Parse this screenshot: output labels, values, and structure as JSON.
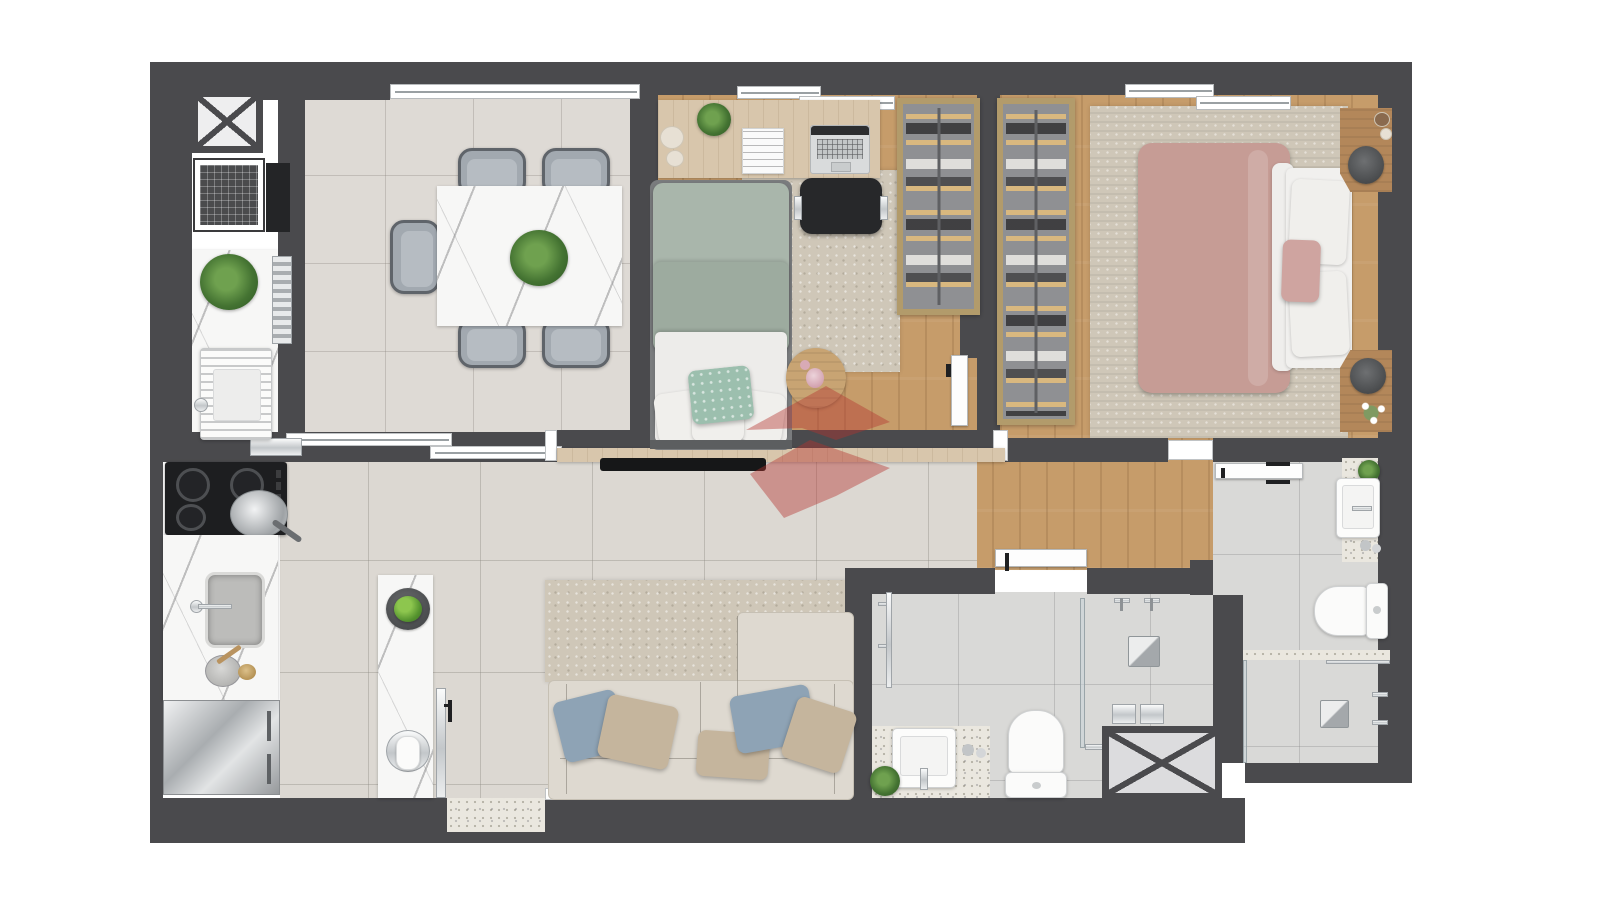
{
  "meta": {
    "type": "apartment-floor-plan",
    "style": "top-down 3D architectural render",
    "background": "#ffffff",
    "visible_text": "none"
  },
  "palette": {
    "wall": "#4a4a4d",
    "wood_floor": "#c69c6a",
    "tile_living": "#dcd8d2",
    "tile_dining": "#dedad5",
    "tile_bath": "#d9d9d7",
    "rug_beige": "#cfc7b8",
    "marble": "#f7f7f6",
    "terrazzo": "#eae7df",
    "sofa_cream": "#ded9d0",
    "duvet_sage": "#a9b6ab",
    "duvet_mauve": "#c69c95",
    "pillow_blue": "#8ea3b5",
    "pillow_taupe": "#c5b59d",
    "closet_wood": "#b29b6b",
    "chrome": "#c3c7ca",
    "plant_green": "#447332",
    "watermark_red": "#b5342f"
  },
  "rooms": [
    {
      "name": "service-area",
      "label": "Service / laundry area",
      "furniture": [
        "duct-shaft",
        "washing-machine",
        "laundry-counter",
        "potted-plant",
        "laundry-tank-sink"
      ]
    },
    {
      "name": "kitchen",
      "label": "Kitchen",
      "furniture": [
        "cooktop",
        "frying-pan",
        "kitchen-sink",
        "mortar",
        "refrigerator",
        "island-counter",
        "fruit-bowl",
        "vase-on-tray"
      ]
    },
    {
      "name": "dining-room",
      "label": "Dining room",
      "furniture": [
        "marble-dining-table",
        "centerpiece-plant",
        "dining-chair-1",
        "dining-chair-2",
        "dining-chair-3",
        "dining-chair-4",
        "dining-chair-5"
      ]
    },
    {
      "name": "living-room",
      "label": "Living room",
      "furniture": [
        "sofa-with-chaise",
        "throw-pillows",
        "area-rug",
        "tv-bench",
        "tv"
      ]
    },
    {
      "name": "bedroom-2",
      "label": "Bedroom 2 / office",
      "furniture": [
        "single-bed",
        "desk",
        "laptop",
        "magazine",
        "candles",
        "desk-plant",
        "office-chair",
        "wardrobe",
        "area-rug",
        "round-side-table",
        "pink-glass"
      ]
    },
    {
      "name": "master-bedroom",
      "label": "Master bedroom",
      "furniture": [
        "double-bed",
        "wardrobe",
        "nightstand-top",
        "nightstand-bottom",
        "area-rug",
        "flowers",
        "decor-trays"
      ]
    },
    {
      "name": "hallway",
      "label": "Hallway",
      "furniture": []
    },
    {
      "name": "social-bathroom",
      "label": "Social bathroom",
      "furniture": [
        "vanity-counter",
        "vessel-sink",
        "toilet",
        "walk-in-shower",
        "shower-drain",
        "towel-rail",
        "plant",
        "cups"
      ]
    },
    {
      "name": "ensuite-bathroom",
      "label": "Ensuite bathroom",
      "furniture": [
        "vanity-counter",
        "vessel-sink",
        "toilet",
        "walk-in-shower",
        "shower-drain",
        "plant",
        "cups"
      ]
    },
    {
      "name": "duct-shaft-2",
      "label": "Duct shaft",
      "furniture": []
    }
  ],
  "openings": {
    "windows": [
      "dining-window-band",
      "bedroom-2-sliding-window",
      "master-sliding-window"
    ],
    "doors": [
      "balcony-glass-door",
      "bedroom-2-door",
      "social-bathroom-door",
      "ensuite-door",
      "master-entrance-opening",
      "kitchen-pass-through",
      "dining-sliding-partition"
    ]
  },
  "watermark": {
    "present": true,
    "color": "#b5342f",
    "shape": "two translucent red chevrons"
  }
}
